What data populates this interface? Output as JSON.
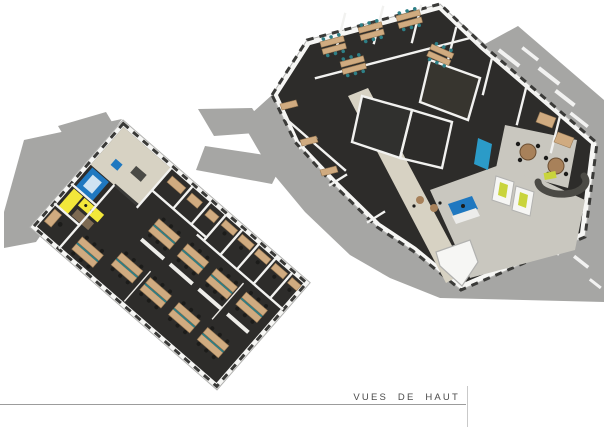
{
  "caption": {
    "label": "VUES DE HAUT"
  },
  "palette": {
    "bg": "#ffffff",
    "shadow": "#a6a6a4",
    "floor_dark": "#2d2c2a",
    "floor_beige": "#d7d2c3",
    "floor_light": "#c9c7bf",
    "wall": "#f6f6f4",
    "wall_edge": "#b2b2b0",
    "window": "#3a3a38",
    "wood": "#d0ab80",
    "wood_dark": "#9a7b55",
    "teal": "#2e7f86",
    "chair": "#1c1c1a",
    "blue": "#1f78c0",
    "blue_light": "#cfe3f2",
    "teal_blue": "#2b9bc8",
    "yellow": "#f2e73a",
    "lime": "#c9d43c",
    "table_wood": "#a8815a",
    "caption": "#4a4a4a",
    "rule": "#9c9c9c",
    "rule_light": "#c9c9c9"
  }
}
